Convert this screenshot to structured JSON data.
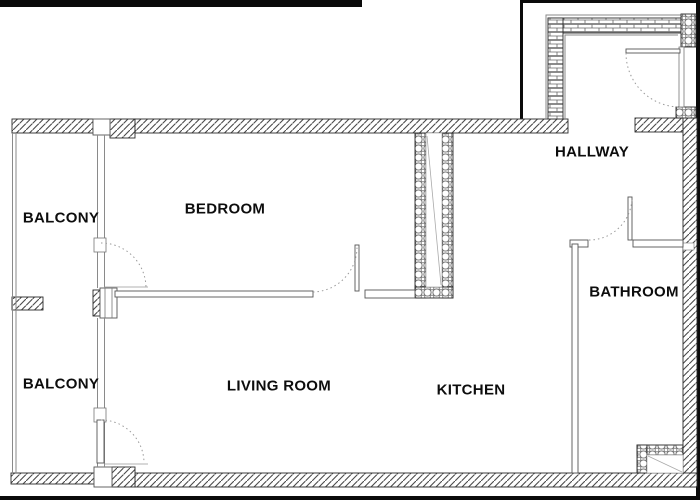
{
  "plan_title": "apartment-floor-plan",
  "rooms": [
    {
      "id": "balcony-top",
      "label": "BALCONY"
    },
    {
      "id": "bedroom",
      "label": "BEDROOM"
    },
    {
      "id": "hallway",
      "label": "HALLWAY"
    },
    {
      "id": "balcony-bottom",
      "label": "BALCONY"
    },
    {
      "id": "living-room",
      "label": "LIVING ROOM"
    },
    {
      "id": "kitchen",
      "label": "KITCHEN"
    },
    {
      "id": "bathroom",
      "label": "BATHROOM"
    }
  ],
  "plan_symbols": [
    "entry-door-swing",
    "bathroom-door-swing",
    "bedroom-door-swing",
    "balcony-door-bedroom-swing",
    "balcony-door-living-swing",
    "kitchen-vent-shaft",
    "bathroom-vent-shaft",
    "balcony-glazing"
  ],
  "colors": {
    "background": "#ffffff",
    "wall_outline": "#2b2b2b",
    "hatch_stroke": "#4a4a4a",
    "thin_line": "#8a8a8a",
    "swing_arc": "#9a9a9a",
    "border_black": "#0a0a0a",
    "label_text": "#0d0d0d"
  }
}
